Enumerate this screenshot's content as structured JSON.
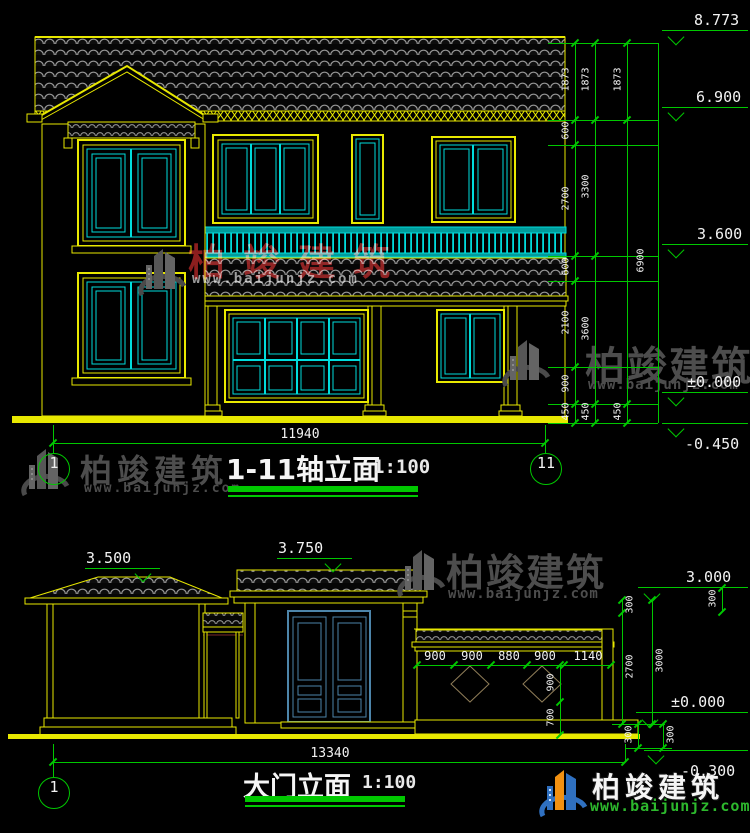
{
  "brand": {
    "name": "柏竣建筑",
    "site": "www.baijunjz.com"
  },
  "colors": {
    "background": "#000000",
    "cad_yellow": "#e8e800",
    "cad_cyan": "#00dcdc",
    "cad_green": "#00c800",
    "text_white": "#f2f2f2",
    "tile_gray": "#989898",
    "door_blue": "#4d85aa",
    "diamond_tan": "#8f7d58",
    "watermark_gray": "#4d4d4d",
    "watermark_red": "#8c1e1e",
    "logo_blue": "#2f70c0",
    "logo_orange": "#f29111",
    "site_green": "#2db82d"
  },
  "drawing1": {
    "title": "1-11轴立面",
    "scale": "1:100",
    "axes": [
      {
        "label": "1",
        "cx": 53,
        "cy": 468
      },
      {
        "label": "11",
        "cx": 545,
        "cy": 468
      }
    ],
    "bottom_dim": {
      "label": "11940",
      "y": 443,
      "x1": 53,
      "x2": 545,
      "lx": 300
    },
    "levels": [
      {
        "label": "8.773",
        "line_y": 30,
        "apex_y": 43,
        "tx": 694,
        "below": false
      },
      {
        "label": "6.900",
        "line_y": 107,
        "apex_y": 119,
        "tx": 696,
        "below": false
      },
      {
        "label": "3.600",
        "line_y": 244,
        "apex_y": 256,
        "tx": 697,
        "below": false
      },
      {
        "label": "±0.000",
        "line_y": 392,
        "apex_y": 404,
        "tx": 687,
        "below": false
      },
      {
        "label": "-0.450",
        "line_y": 423,
        "apex_y": 435,
        "tx": 685,
        "below": true
      }
    ],
    "level_x1": 662,
    "level_x2": 748,
    "apex_x": 676,
    "ext_x1": 548,
    "ext_x2": 658,
    "ext_ys": [
      43,
      120,
      145,
      256,
      281,
      367,
      404,
      423
    ],
    "boundary_x": 658,
    "columns": [
      {
        "x": 575,
        "ldx": -9,
        "ticks": [
          43,
          120,
          145,
          256,
          281,
          367,
          404,
          423
        ],
        "labels": [
          [
            "1873",
            81
          ],
          [
            "600",
            132
          ],
          [
            "2700",
            200
          ],
          [
            "600",
            268
          ],
          [
            "2100",
            324
          ],
          [
            "900",
            385
          ],
          [
            "450",
            413
          ]
        ]
      },
      {
        "x": 595,
        "ldx": -9,
        "ticks": [
          43,
          120,
          256,
          404,
          423
        ],
        "labels": [
          [
            "1873",
            81
          ],
          [
            "3300",
            188
          ],
          [
            "3600",
            330
          ],
          [
            "450",
            413
          ]
        ]
      },
      {
        "x": 627,
        "ldx": -9,
        "ticks": [
          43,
          120,
          404,
          423
        ],
        "labels": [
          [
            "1873",
            81
          ],
          [
            "6900",
            262,
            14
          ],
          [
            "450",
            413
          ]
        ]
      }
    ],
    "vstubs": []
  },
  "drawing2": {
    "title": "大门立面",
    "scale": "1:100",
    "axes": [
      {
        "label": "1",
        "cx": 53,
        "cy": 792
      }
    ],
    "bottom_dim": {
      "label": "13340",
      "y": 762,
      "x1": 53,
      "x2": 625,
      "lx": 330
    },
    "levels": [
      {
        "label": "3.500",
        "line_y": 568,
        "apex_y": 580,
        "x1": 85,
        "x2": 160,
        "apex_x": 143,
        "tx": 86,
        "below": false
      },
      {
        "label": "3.750",
        "line_y": 558,
        "apex_y": 570,
        "x1": 277,
        "x2": 352,
        "apex_x": 333,
        "tx": 278,
        "below": false
      },
      {
        "label": "3.000",
        "line_y": 587,
        "apex_y": 600,
        "x1": 638,
        "x2": 748,
        "apex_x": 652,
        "tx": 686,
        "below": false
      },
      {
        "label": "±0.000",
        "line_y": 712,
        "apex_y": 726,
        "x1": 636,
        "x2": 748,
        "apex_x": 650,
        "tx": 671,
        "below": false
      },
      {
        "label": "-0.300",
        "line_y": 750,
        "apex_y": 762,
        "x1": 644,
        "x2": 748,
        "apex_x": 656,
        "tx": 681,
        "below": true
      }
    ],
    "fence_dim": {
      "y": 665,
      "x1": 417,
      "x2": 611,
      "ticks": [
        417,
        454,
        491,
        527,
        564,
        611
      ],
      "labels": [
        [
          "900",
          435
        ],
        [
          "900",
          472
        ],
        [
          "880",
          509
        ],
        [
          "900",
          545
        ],
        [
          "1140",
          588
        ]
      ]
    },
    "vcolumns": [
      {
        "x": 560,
        "ldx": -9,
        "ticks": [
          665,
          702,
          735
        ],
        "labels": [
          [
            "900",
            684
          ],
          [
            "700",
            719
          ]
        ]
      },
      {
        "x": 622,
        "ldx": 8,
        "ticks": [
          600,
          613,
          724
        ],
        "labels": [
          [
            "300",
            606
          ],
          [
            "2700",
            668
          ]
        ]
      },
      {
        "x": 652,
        "ldx": 8,
        "ticks": [
          600,
          724
        ],
        "labels": [
          [
            "3000",
            662
          ]
        ]
      },
      {
        "x": 638,
        "ldx": -9,
        "ticks": [
          724,
          748
        ],
        "labels": [
          [
            "300",
            736
          ]
        ]
      },
      {
        "x": 663,
        "ldx": 8,
        "ticks": [
          724,
          748
        ],
        "labels": [
          [
            "300",
            736
          ]
        ]
      },
      {
        "x": 722,
        "ldx": -9,
        "ticks": [
          588,
          612
        ],
        "labels": [
          [
            "300",
            600
          ]
        ]
      }
    ],
    "ext": [
      {
        "x1": 612,
        "x2": 665,
        "y": 724
      },
      {
        "x1": 626,
        "x2": 672,
        "y": 748
      }
    ],
    "vstubs": [
      [
        625,
        744,
        762
      ]
    ]
  },
  "watermarks": [
    {
      "mode": "red",
      "logo": [
        133,
        243
      ],
      "brand": [
        188,
        232,
        37,
        18
      ],
      "site": [
        192,
        271,
        14,
        2
      ]
    },
    {
      "mode": "gray",
      "logo": [
        497,
        334
      ],
      "brand": [
        585,
        334,
        40,
        2
      ],
      "site": [
        588,
        377,
        14,
        1
      ]
    },
    {
      "mode": "gray",
      "logo": [
        16,
        443
      ],
      "brand": [
        80,
        446,
        32,
        5
      ],
      "site": [
        84,
        481,
        13,
        2
      ]
    },
    {
      "mode": "gray",
      "logo": [
        392,
        544
      ],
      "brand": [
        446,
        542,
        38,
        2
      ],
      "site": [
        448,
        586,
        14,
        1
      ]
    },
    {
      "mode": "color",
      "logo": [
        534,
        764
      ],
      "brand": [
        592,
        766,
        28,
        5
      ],
      "site": [
        590,
        797,
        15,
        1
      ]
    }
  ]
}
